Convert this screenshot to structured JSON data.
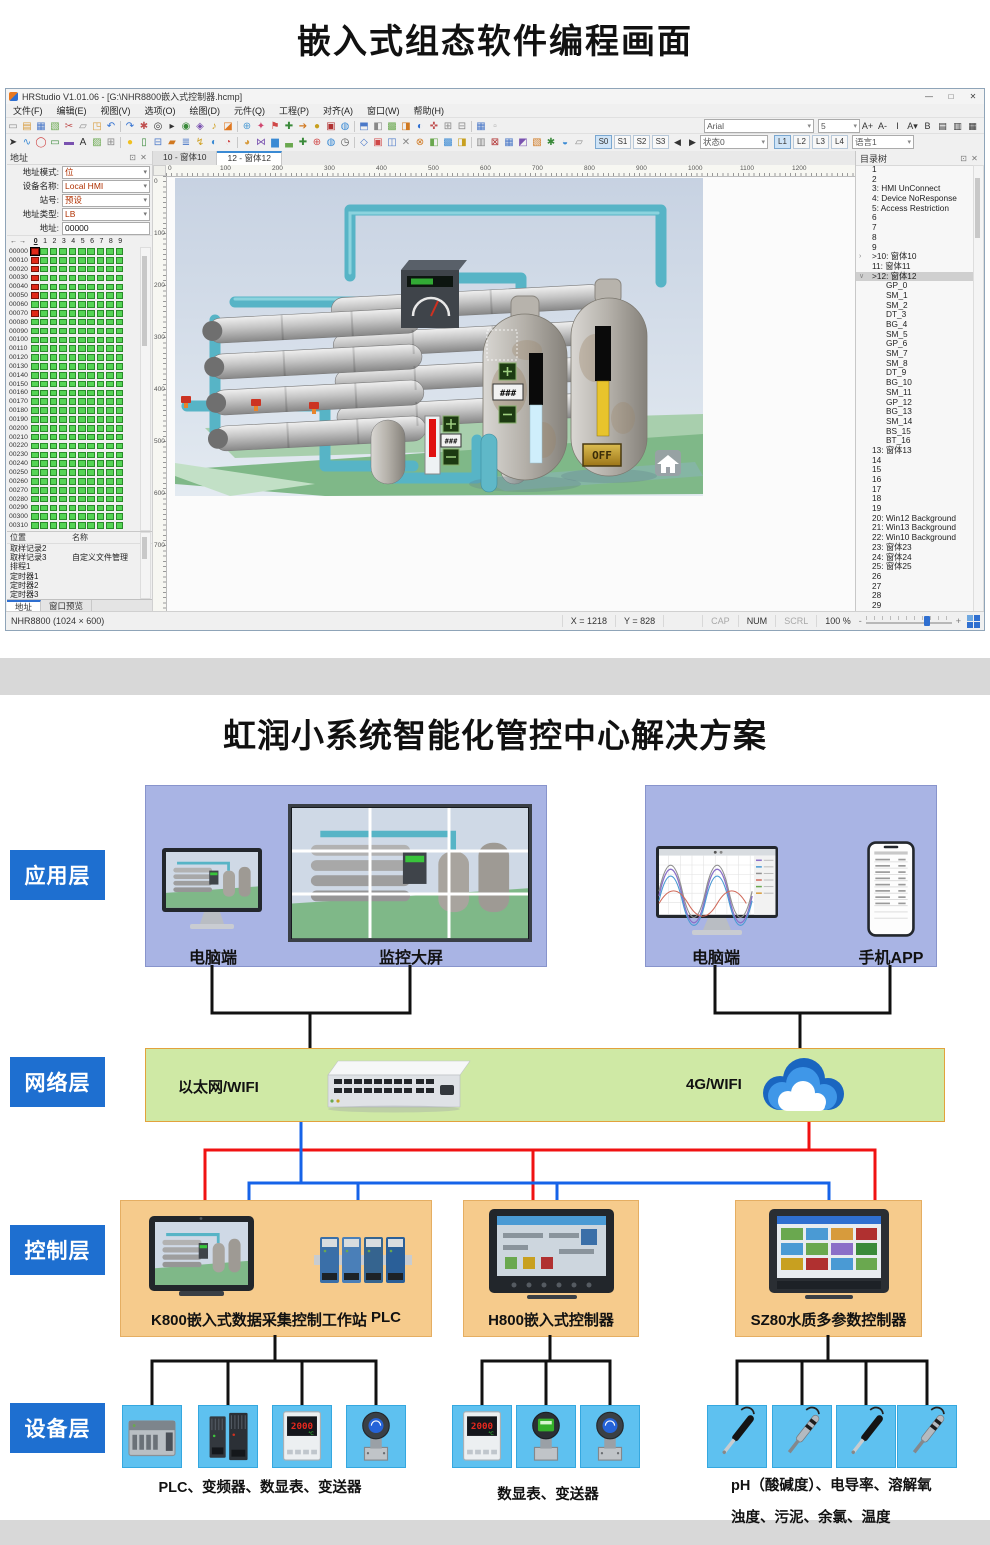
{
  "page": {
    "top_title": "嵌入式组态软件编程画面"
  },
  "window": {
    "title": "HRStudio V1.01.06 - [G:\\NHR8800嵌入式控制器.hcmp]",
    "controls": {
      "minimize": "—",
      "maximize": "□",
      "close": "✕"
    },
    "menus": [
      "文件(F)",
      "编辑(E)",
      "视图(V)",
      "选项(O)",
      "绘图(D)",
      "元件(Q)",
      "工程(P)",
      "对齐(A)",
      "窗口(W)",
      "帮助(H)"
    ],
    "toolbar1_icons": [
      {
        "g": "▭",
        "c": "#8a8a8a"
      },
      {
        "g": "▤",
        "c": "#d79b3c"
      },
      {
        "g": "▦",
        "c": "#4a78c8"
      },
      {
        "g": "▧",
        "c": "#6aa84f"
      },
      {
        "g": "✂",
        "c": "#c05050"
      },
      {
        "g": "▱",
        "c": "#888888"
      },
      {
        "g": "◳",
        "c": "#d79b3c"
      },
      {
        "g": "↶",
        "c": "#2f6fd0"
      },
      {
        "g": "↷",
        "c": "#2f6fd0"
      },
      {
        "g": "✱",
        "c": "#c05050"
      },
      {
        "g": "◎",
        "c": "#333333"
      },
      {
        "g": "▸",
        "c": "#333333"
      },
      {
        "g": "◉",
        "c": "#3a8a3a"
      },
      {
        "g": "◈",
        "c": "#7a52b0"
      },
      {
        "g": "♪",
        "c": "#d0a020"
      },
      {
        "g": "◪",
        "c": "#e07820"
      },
      {
        "g": "⊕",
        "c": "#4a9ad4"
      },
      {
        "g": "✦",
        "c": "#d04870"
      },
      {
        "g": "⚑",
        "c": "#d04848"
      },
      {
        "g": "✚",
        "c": "#3a8a3a"
      },
      {
        "g": "➔",
        "c": "#d07820"
      },
      {
        "g": "●",
        "c": "#c8a020"
      },
      {
        "g": "▣",
        "c": "#b03030"
      },
      {
        "g": "◍",
        "c": "#3a8ad4"
      },
      {
        "g": "⬒",
        "c": "#4a78c8"
      },
      {
        "g": "◧",
        "c": "#888888"
      },
      {
        "g": "▩",
        "c": "#6aa84f"
      },
      {
        "g": "◨",
        "c": "#d07820"
      },
      {
        "g": "◐",
        "c": "#2f6fd0"
      },
      {
        "g": "✜",
        "c": "#c05050"
      },
      {
        "g": "⊞",
        "c": "#888888"
      },
      {
        "g": "⊟",
        "c": "#888888"
      },
      {
        "g": "▦",
        "c": "#4a78c8"
      },
      {
        "g": "▫",
        "c": "#aaaaaa"
      }
    ],
    "toolbar2_icons": [
      {
        "g": "➤",
        "c": "#333333"
      },
      {
        "g": "∿",
        "c": "#3a8ad4"
      },
      {
        "g": "◯",
        "c": "#d04848"
      },
      {
        "g": "▭",
        "c": "#3a8a3a"
      },
      {
        "g": "▬",
        "c": "#7a52b0"
      },
      {
        "g": "A",
        "c": "#333333"
      },
      {
        "g": "▨",
        "c": "#6aa84f"
      },
      {
        "g": "⊞",
        "c": "#888888"
      },
      {
        "g": "●",
        "c": "#f0c020"
      },
      {
        "g": "▯",
        "c": "#3a8a3a"
      },
      {
        "g": "⊟",
        "c": "#4a78c8"
      },
      {
        "g": "▰",
        "c": "#d07820"
      },
      {
        "g": "≣",
        "c": "#4a78c8"
      },
      {
        "g": "↯",
        "c": "#d0a020"
      },
      {
        "g": "◐",
        "c": "#3a8ad4"
      },
      {
        "g": "◔",
        "c": "#d04848"
      },
      {
        "g": "◕",
        "c": "#d79b3c"
      },
      {
        "g": "⋈",
        "c": "#7a52b0"
      },
      {
        "g": "▆",
        "c": "#3a8ad4"
      },
      {
        "g": "▃",
        "c": "#6aa84f"
      },
      {
        "g": "✚",
        "c": "#3a8a3a"
      },
      {
        "g": "⊕",
        "c": "#d04848"
      },
      {
        "g": "◍",
        "c": "#3a8ad4"
      },
      {
        "g": "◷",
        "c": "#555555"
      },
      {
        "g": "◇",
        "c": "#4a78c8"
      },
      {
        "g": "▣",
        "c": "#d04848"
      },
      {
        "g": "◫",
        "c": "#4a78c8"
      },
      {
        "g": "✕",
        "c": "#888888"
      },
      {
        "g": "⊗",
        "c": "#d07820"
      },
      {
        "g": "◧",
        "c": "#6aa84f"
      },
      {
        "g": "▩",
        "c": "#3a8ad4"
      },
      {
        "g": "◨",
        "c": "#c8a020"
      },
      {
        "g": "▥",
        "c": "#888888"
      },
      {
        "g": "⊠",
        "c": "#b03030"
      },
      {
        "g": "▦",
        "c": "#4a78c8"
      },
      {
        "g": "◩",
        "c": "#7a52b0"
      },
      {
        "g": "▧",
        "c": "#d07820"
      },
      {
        "g": "✱",
        "c": "#3a8a3a"
      },
      {
        "g": "◒",
        "c": "#3a8ad4"
      },
      {
        "g": "▱",
        "c": "#888888"
      }
    ],
    "font_combo": {
      "font": "Arial",
      "size": "5"
    },
    "font_buttons": [
      "A+",
      "A-",
      "I",
      "A▾",
      "B",
      "▤",
      "▥",
      "▦"
    ],
    "state_bar": {
      "s_buttons": [
        "S0",
        "S1",
        "S2",
        "S3"
      ],
      "prev": "◀",
      "next": "▶",
      "state_select": "状态0",
      "l_buttons": [
        "L1",
        "L2",
        "L3",
        "L4"
      ],
      "lang_select": "语言1"
    }
  },
  "address_panel": {
    "header": "地址",
    "header_icons": [
      "⊡",
      "✕"
    ],
    "fields": [
      {
        "label": "地址模式:",
        "value": "位",
        "type": "select"
      },
      {
        "label": "设备名称:",
        "value": "Local HMI",
        "type": "select"
      },
      {
        "label": "站号:",
        "value": "预设",
        "type": "select"
      },
      {
        "label": "地址类型:",
        "value": "LB",
        "type": "select"
      },
      {
        "label": "地址:",
        "value": "00000",
        "type": "input"
      }
    ],
    "grid": {
      "nav_icons": [
        "←",
        "→"
      ],
      "col_headers": [
        "0",
        "1",
        "2",
        "3",
        "4",
        "5",
        "6",
        "7",
        "8",
        "9"
      ],
      "selected_col": "0",
      "row_start": 0,
      "row_step": 10,
      "row_count": 32,
      "red_rows": [
        0,
        1,
        2,
        3,
        4,
        5,
        7
      ]
    },
    "bottom_table": {
      "headers": [
        "位置",
        "名称"
      ],
      "rows": [
        [
          "取样记录2",
          ""
        ],
        [
          "取样记录3",
          "自定义文件管理"
        ],
        [
          "排程1",
          ""
        ],
        [
          "定时器1",
          ""
        ],
        [
          "定时器2",
          ""
        ],
        [
          "定时器3",
          ""
        ]
      ]
    },
    "tabs": [
      {
        "label": "地址",
        "active": true
      },
      {
        "label": "窗口预览",
        "active": false
      }
    ]
  },
  "canvas": {
    "tabs": [
      {
        "label": "10 - 窗体10",
        "active": false
      },
      {
        "label": "12 - 窗体12",
        "active": true
      }
    ],
    "h_ruler": {
      "start": 0,
      "step": 100,
      "count": 13
    },
    "v_ruler": {
      "start": 0,
      "step": 100,
      "count": 8
    },
    "scene": {
      "value_text": "###",
      "off_text": "OFF"
    }
  },
  "tree_panel": {
    "header": "目录树",
    "items": [
      {
        "t": "1"
      },
      {
        "t": "2"
      },
      {
        "t": "3:  HMI UnConnect"
      },
      {
        "t": "4:  Device NoResponse"
      },
      {
        "t": "5:  Access Restriction"
      },
      {
        "t": "6"
      },
      {
        "t": "7"
      },
      {
        "t": "8"
      },
      {
        "t": "9"
      },
      {
        "t": ">10:  窗体10",
        "a": "›"
      },
      {
        "t": "11:  窗体11"
      },
      {
        "t": ">12:  窗体12",
        "a": "∨",
        "s": true
      },
      {
        "t": "GP_0",
        "i": 1
      },
      {
        "t": "SM_1",
        "i": 1
      },
      {
        "t": "SM_2",
        "i": 1
      },
      {
        "t": "DT_3",
        "i": 1
      },
      {
        "t": "BG_4",
        "i": 1
      },
      {
        "t": "SM_5",
        "i": 1
      },
      {
        "t": "GP_6",
        "i": 1
      },
      {
        "t": "SM_7",
        "i": 1
      },
      {
        "t": "SM_8",
        "i": 1
      },
      {
        "t": "DT_9",
        "i": 1
      },
      {
        "t": "BG_10",
        "i": 1
      },
      {
        "t": "SM_11",
        "i": 1
      },
      {
        "t": "GP_12",
        "i": 1
      },
      {
        "t": "BG_13",
        "i": 1
      },
      {
        "t": "SM_14",
        "i": 1
      },
      {
        "t": "BS_15",
        "i": 1
      },
      {
        "t": "BT_16",
        "i": 1
      },
      {
        "t": "13:  窗体13"
      },
      {
        "t": "14"
      },
      {
        "t": "15"
      },
      {
        "t": "16"
      },
      {
        "t": "17"
      },
      {
        "t": "18"
      },
      {
        "t": "19"
      },
      {
        "t": "20:  Win12 Background"
      },
      {
        "t": "21:  Win13 Background"
      },
      {
        "t": "22:  Win10 Background"
      },
      {
        "t": "23:  窗体23"
      },
      {
        "t": "24:  窗体24"
      },
      {
        "t": "25:  窗体25"
      },
      {
        "t": "26"
      },
      {
        "t": "27"
      },
      {
        "t": "28"
      },
      {
        "t": "29"
      }
    ]
  },
  "status_bar": {
    "left": "NHR8800 (1024 × 600)",
    "x": "X = 1218",
    "y": "Y = 828",
    "cap": "CAP",
    "num": "NUM",
    "scrl": "SCRL",
    "zoom": "100 %",
    "minus": "-",
    "plus": "+"
  },
  "diagram": {
    "title": "虹润小系统智能化管控中心解决方案",
    "layer_labels": [
      "应用层",
      "网络层",
      "控制层",
      "设备层"
    ],
    "app_left_items": [
      {
        "label": "电脑端"
      },
      {
        "label": "监控大屏"
      }
    ],
    "app_right_items": [
      {
        "label": "电脑端"
      },
      {
        "label": "手机APP"
      }
    ],
    "network": {
      "ethernet": "以太网/WIFI",
      "cellular": "4G/WIFI"
    },
    "control_boxes": [
      {
        "title": "K800嵌入式数据采集控制工作站",
        "title2": "PLC"
      },
      {
        "title": "H800嵌入式控制器"
      },
      {
        "title": "SZ80水质多参数控制器"
      }
    ],
    "device_groups": [
      {
        "caption": "PLC、变频器、数显表、变送器",
        "caption2": "",
        "devices": [
          "plc",
          "inverter",
          "meter",
          "transmitter-blue"
        ]
      },
      {
        "caption": "数显表、变送器",
        "caption2": "",
        "devices": [
          "meter",
          "transmitter-green",
          "transmitter-blue"
        ]
      },
      {
        "caption": "pH（酸碱度）、电导率、溶解氧",
        "caption2": "浊度、污泥、余氯、温度",
        "devices": [
          "probe-black",
          "probe-silver",
          "probe-black",
          "probe-silver"
        ]
      }
    ],
    "meter_display": "2000",
    "meter_unit": "℃",
    "colors": {
      "layer_blue": "#1e6fd0",
      "panel_purple": "#a9b4e4",
      "band_green": "#cfe9a5",
      "box_orange": "#f6cb8c",
      "card_blue": "#5ec1f0",
      "line_red": "#f01212",
      "line_blue": "#1663e8",
      "line_black": "#111111"
    }
  }
}
